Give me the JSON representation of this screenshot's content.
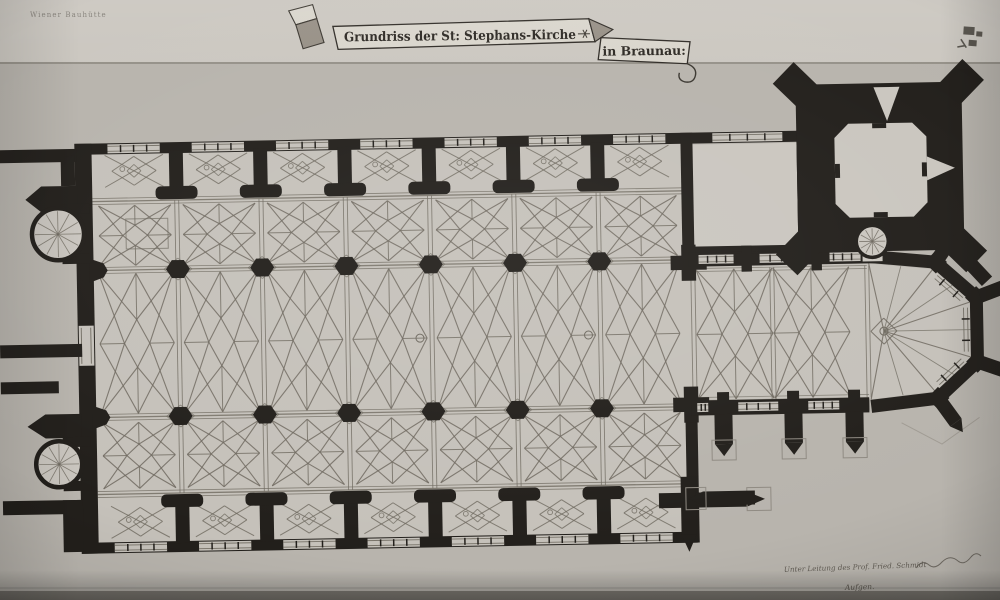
{
  "banner": {
    "title": "Grundriss der St: Stephans-Kirche",
    "location": "in Braunau:"
  },
  "annotations": {
    "stamp_top_left": "Wiener Bauhütte",
    "credit_line": "Unter Leitung des Prof. Fried. Schmidt",
    "credit_line2": "Aufgen."
  },
  "plan": {
    "subject": "Floor plan of St. Stephan's church, Braunau",
    "elements": [
      "nave",
      "side-chapels",
      "choir",
      "apse",
      "tower",
      "sacristy",
      "spiral-stairs",
      "buttresses"
    ]
  },
  "colors": {
    "paper": "#b8b4ad",
    "paper_top": "#cbc7c0",
    "paper_bottom": "#7e7a73",
    "interior": "#c5c1ba",
    "room": "#cac6bf",
    "wall": "#221f1b",
    "rib": "#6e695f",
    "faint": "#8f8a82",
    "banner_fill": "#d9d5cc",
    "banner_shade": "#968f85",
    "ink": "#2b2722",
    "note_ink": "#5f5a52"
  }
}
